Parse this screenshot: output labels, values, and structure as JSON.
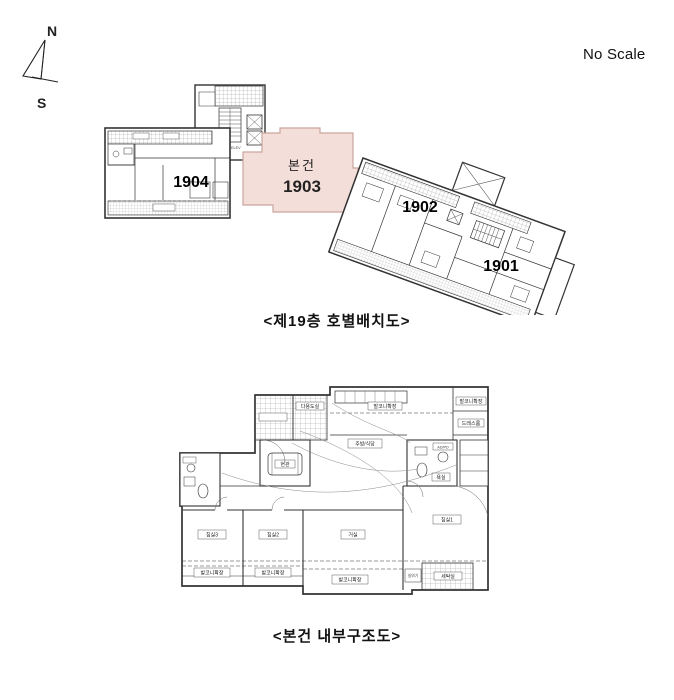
{
  "compass": {
    "north": "N",
    "south": "S"
  },
  "scale_note": "No Scale",
  "top_plan": {
    "caption": "<제19층 호별배치도>",
    "subject_label": "본건",
    "subject_number": "1903",
    "unit_1904": "1904",
    "unit_1902": "1902",
    "unit_1901": "1901",
    "elevator_label": "ELEV",
    "colors": {
      "highlight_fill": "#f4ded9",
      "highlight_stroke": "#c9a59c",
      "subject_text": "#cc3333",
      "subject_number_text": "#cc0000"
    }
  },
  "bottom_plan": {
    "caption": "<본건 내부구조도>",
    "rooms": {
      "living": "거실",
      "bedroom1": "침실1",
      "bedroom2": "침실2",
      "bedroom3": "침실3",
      "kitchen": "주방/식당",
      "entry": "현관",
      "bath": "욕실",
      "dress": "드레스룸",
      "utility": "다용도실",
      "balcony_ext": "발코니확장",
      "laundry": "세탁실",
      "outdoor_unit": "실외기",
      "ad_pd": "AD/PD"
    }
  }
}
